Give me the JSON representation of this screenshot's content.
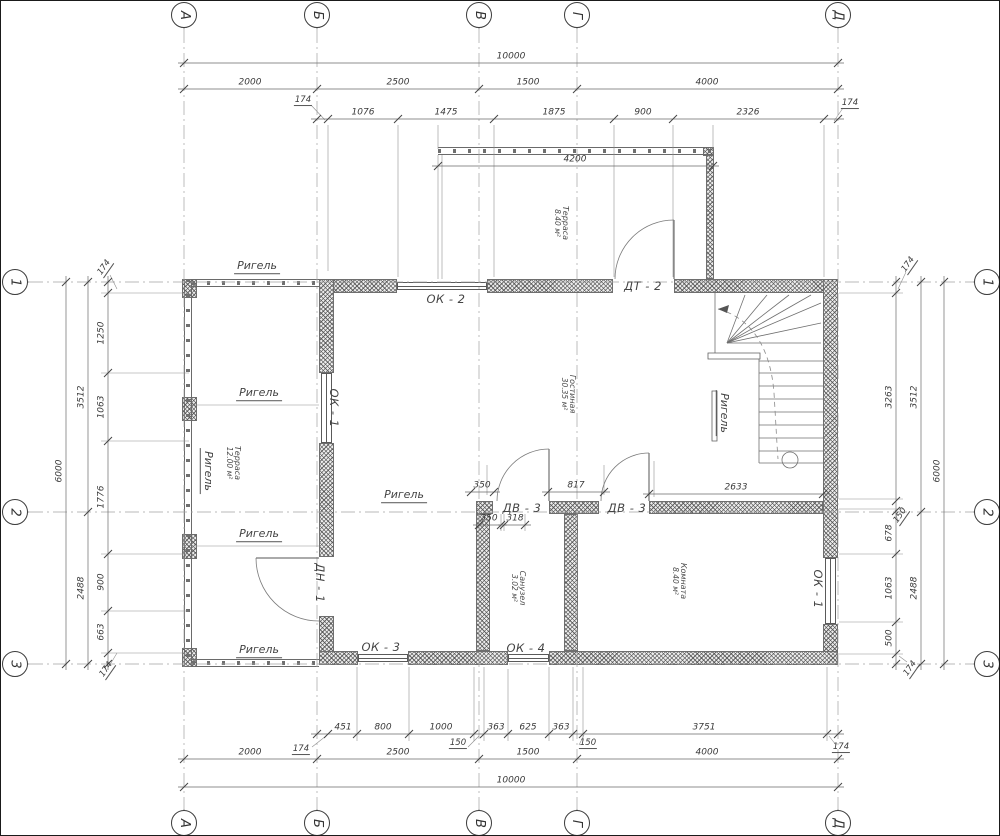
{
  "axes": {
    "letters": [
      {
        "label": "А",
        "x": 183
      },
      {
        "label": "Б",
        "x": 316
      },
      {
        "label": "В",
        "x": 478
      },
      {
        "label": "Г",
        "x": 576
      },
      {
        "label": "Д",
        "x": 837
      }
    ],
    "letter_rows": [
      {
        "side": "top",
        "y": 14
      },
      {
        "side": "bottom",
        "y": 822
      }
    ],
    "numbers": [
      {
        "label": "1",
        "y": 281
      },
      {
        "label": "2",
        "y": 511
      },
      {
        "label": "3",
        "y": 663
      }
    ],
    "number_cols": [
      {
        "side": "left",
        "x": 14
      },
      {
        "side": "right",
        "x": 986
      }
    ]
  },
  "h_dim_rows": [
    {
      "name": "top-total",
      "y": 62,
      "x1": 183,
      "x2": 837,
      "ticks": [
        183,
        837
      ],
      "labels": [
        {
          "text": "10000",
          "x": 510
        }
      ]
    },
    {
      "name": "top-axes",
      "y": 88,
      "x1": 183,
      "x2": 837,
      "ticks": [
        183,
        316,
        478,
        576,
        837
      ],
      "labels": [
        {
          "text": "2000",
          "x": 249
        },
        {
          "text": "2500",
          "x": 397
        },
        {
          "text": "1500",
          "x": 527
        },
        {
          "text": "4000",
          "x": 706
        }
      ]
    },
    {
      "name": "top-inner",
      "y": 118,
      "x1": 316,
      "x2": 837,
      "ticks": [
        316,
        327,
        397,
        493,
        613,
        672,
        823,
        837
      ],
      "labels": [
        {
          "text": "1076",
          "x": 362
        },
        {
          "text": "1475",
          "x": 445
        },
        {
          "text": "1875",
          "x": 553
        },
        {
          "text": "900",
          "x": 642
        },
        {
          "text": "2326",
          "x": 747
        }
      ]
    },
    {
      "name": "terrace-width",
      "y": 165,
      "x1": 437,
      "x2": 712,
      "ticks": [
        437,
        712
      ],
      "labels": [
        {
          "text": "4200",
          "x": 574
        }
      ]
    },
    {
      "name": "stair-width",
      "y": 493,
      "x1": 648,
      "x2": 822,
      "ticks": [
        648,
        822
      ],
      "labels": [
        {
          "text": "2633",
          "x": 735
        }
      ]
    },
    {
      "name": "door-dim-1",
      "y": 491,
      "x1": 470,
      "x2": 493,
      "ticks": [
        470,
        493
      ],
      "labels": [
        {
          "text": "350",
          "x": 481
        }
      ]
    },
    {
      "name": "door-dim-2",
      "y": 491,
      "x1": 547,
      "x2": 603,
      "ticks": [
        547,
        603
      ],
      "labels": [
        {
          "text": "817",
          "x": 575
        }
      ]
    },
    {
      "name": "wc-dim-1",
      "y": 524,
      "x1": 478,
      "x2": 500,
      "ticks": [
        478,
        500
      ],
      "labels": [
        {
          "text": "350",
          "x": 488
        }
      ]
    },
    {
      "name": "wc-dim-2",
      "y": 524,
      "x1": 503,
      "x2": 524,
      "ticks": [
        503,
        524
      ],
      "labels": [
        {
          "text": "318",
          "x": 514
        }
      ]
    },
    {
      "name": "bottom-inner",
      "y": 733,
      "x1": 316,
      "x2": 837,
      "ticks": [
        316,
        327,
        356,
        408,
        473,
        483,
        507,
        548,
        572,
        582,
        826,
        837
      ],
      "labels": [
        {
          "text": "451",
          "x": 342
        },
        {
          "text": "800",
          "x": 382
        },
        {
          "text": "1000",
          "x": 440
        },
        {
          "text": "363",
          "x": 495
        },
        {
          "text": "625",
          "x": 527
        },
        {
          "text": "363",
          "x": 560
        },
        {
          "text": "3751",
          "x": 703
        }
      ]
    },
    {
      "name": "bottom-axes",
      "y": 758,
      "x1": 183,
      "x2": 837,
      "ticks": [
        183,
        316,
        478,
        576,
        837
      ],
      "labels": [
        {
          "text": "2000",
          "x": 249
        },
        {
          "text": "2500",
          "x": 397
        },
        {
          "text": "1500",
          "x": 527
        },
        {
          "text": "4000",
          "x": 706
        }
      ]
    },
    {
      "name": "bottom-total",
      "y": 786,
      "x1": 183,
      "x2": 837,
      "ticks": [
        183,
        837
      ],
      "labels": [
        {
          "text": "10000",
          "x": 510
        }
      ]
    }
  ],
  "v_dim_cols": [
    {
      "name": "left-total",
      "x": 65,
      "y1": 281,
      "y2": 663,
      "ticks": [
        281,
        663
      ],
      "labels": [
        {
          "text": "6000",
          "y": 470
        }
      ]
    },
    {
      "name": "left-axes",
      "x": 87,
      "y1": 281,
      "y2": 663,
      "ticks": [
        281,
        511,
        663
      ],
      "labels": [
        {
          "text": "3512",
          "y": 396
        },
        {
          "text": "2488",
          "y": 587
        }
      ]
    },
    {
      "name": "left-inner",
      "x": 107,
      "y1": 281,
      "y2": 663,
      "ticks": [
        281,
        292,
        372,
        440,
        553,
        610,
        652,
        663
      ],
      "labels": [
        {
          "text": "1250",
          "y": 332
        },
        {
          "text": "1063",
          "y": 406
        },
        {
          "text": "1776",
          "y": 496
        },
        {
          "text": "900",
          "y": 581
        },
        {
          "text": "663",
          "y": 631
        }
      ]
    },
    {
      "name": "right-inner",
      "x": 895,
      "y1": 281,
      "y2": 663,
      "ticks": [
        281,
        292,
        500,
        510,
        553,
        621,
        653,
        663
      ],
      "labels": [
        {
          "text": "3263",
          "y": 396
        },
        {
          "text": "678",
          "y": 532
        },
        {
          "text": "1063",
          "y": 587
        },
        {
          "text": "500",
          "y": 637
        }
      ]
    },
    {
      "name": "right-axes",
      "x": 920,
      "y1": 281,
      "y2": 663,
      "ticks": [
        281,
        511,
        663
      ],
      "labels": [
        {
          "text": "3512",
          "y": 396
        },
        {
          "text": "2488",
          "y": 587
        }
      ]
    },
    {
      "name": "right-total",
      "x": 943,
      "y1": 281,
      "y2": 663,
      "ticks": [
        281,
        663
      ],
      "labels": [
        {
          "text": "6000",
          "y": 470
        }
      ]
    }
  ],
  "small_dims": [
    {
      "text": "174",
      "x": 302,
      "y": 100,
      "rot": 0
    },
    {
      "text": "174",
      "x": 849,
      "y": 103,
      "rot": 0
    },
    {
      "text": "174",
      "x": 104,
      "y": 267,
      "rot": -55
    },
    {
      "text": "174",
      "x": 106,
      "y": 669,
      "rot": -55
    },
    {
      "text": "174",
      "x": 908,
      "y": 264,
      "rot": -55
    },
    {
      "text": "150",
      "x": 900,
      "y": 515,
      "rot": -55
    },
    {
      "text": "174",
      "x": 910,
      "y": 668,
      "rot": -55
    },
    {
      "text": "174",
      "x": 300,
      "y": 749,
      "rot": 0
    },
    {
      "text": "150",
      "x": 457,
      "y": 743,
      "rot": 0
    },
    {
      "text": "150",
      "x": 587,
      "y": 743,
      "rot": 0
    },
    {
      "text": "174",
      "x": 840,
      "y": 747,
      "rot": 0
    }
  ],
  "openings": [
    {
      "label": "ОК - 2",
      "x": 445,
      "y": 298,
      "rot": 0
    },
    {
      "label": "ДТ - 2",
      "x": 642,
      "y": 285,
      "rot": 0
    },
    {
      "label": "ОК - 1",
      "x": 333,
      "y": 407,
      "rot": 90
    },
    {
      "label": "ДВ - 3",
      "x": 521,
      "y": 507,
      "rot": 0
    },
    {
      "label": "ДВ - 3",
      "x": 626,
      "y": 507,
      "rot": 0
    },
    {
      "label": "ДН - 1",
      "x": 319,
      "y": 582,
      "rot": 90
    },
    {
      "label": "ОК - 3",
      "x": 380,
      "y": 646,
      "rot": 0
    },
    {
      "label": "ОК - 4",
      "x": 525,
      "y": 647,
      "rot": 0
    },
    {
      "label": "ОК - 1",
      "x": 817,
      "y": 588,
      "rot": 90
    }
  ],
  "rooms": [
    {
      "name": "Терраса",
      "area": "8.40 м²",
      "x": 560,
      "y": 222
    },
    {
      "name": "Гостиная",
      "area": "30.35 м²",
      "x": 567,
      "y": 393
    },
    {
      "name": "Терраса",
      "area": "12.00 м²",
      "x": 232,
      "y": 462
    },
    {
      "name": "Санузел",
      "area": "3.02 м²",
      "x": 517,
      "y": 587
    },
    {
      "name": "Комната",
      "area": "8.40 м²",
      "x": 678,
      "y": 580
    }
  ],
  "beams": [
    {
      "label": "Ригель",
      "x": 256,
      "y": 266,
      "rot": 0
    },
    {
      "label": "Ригель",
      "x": 258,
      "y": 393,
      "rot": 0
    },
    {
      "label": "Ригель",
      "x": 403,
      "y": 495,
      "rot": 0
    },
    {
      "label": "Ригель",
      "x": 258,
      "y": 534,
      "rot": 0
    },
    {
      "label": "Ригель",
      "x": 258,
      "y": 650,
      "rot": 0
    },
    {
      "label": "Ригель",
      "x": 206,
      "y": 470,
      "rot": 90
    },
    {
      "label": "Ригель",
      "x": 722,
      "y": 412,
      "rot": 90
    }
  ]
}
